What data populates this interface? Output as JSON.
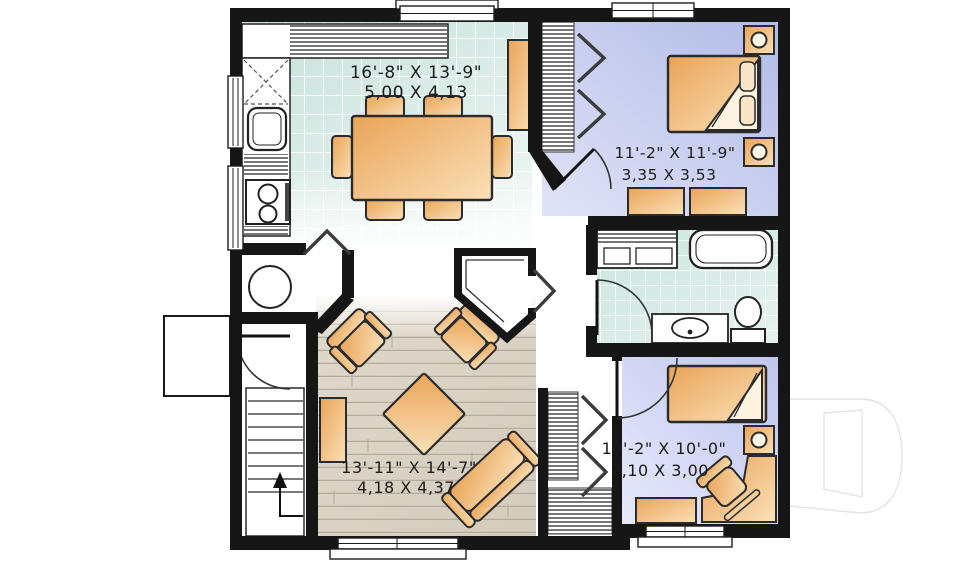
{
  "plan": {
    "type": "floor-plan",
    "rooms": [
      {
        "id": "kitchen-dining",
        "label_imperial": "16'-8\" X 13'-9\"",
        "label_metric": "5,00 X 4,13",
        "features": [
          "l-shaped-counter",
          "corner-cabinet",
          "sink",
          "range",
          "pantry-cabinet",
          "dining-table",
          "six-chairs"
        ]
      },
      {
        "id": "bedroom-1",
        "label_imperial": "11'-2\" X 11'-9\"",
        "label_metric": "3,35 X 3,53",
        "features": [
          "double-bed",
          "two-night-tables-with-lamps",
          "two-dressers",
          "bifold-closet"
        ]
      },
      {
        "id": "living-room",
        "label_imperial": "13'-11\" X 14'-7\"",
        "label_metric": "4,18 X 4,37",
        "features": [
          "sofa",
          "two-armchairs",
          "coffee-table",
          "tv-console",
          "wood-floor"
        ]
      },
      {
        "id": "bedroom-2",
        "label_imperial": "10'-2\" X 10'-0\"",
        "label_metric": "3,10 X 3,00",
        "features": [
          "bed",
          "night-table-with-lamp",
          "corner-desk",
          "desk-chair",
          "dresser"
        ]
      }
    ],
    "other_spaces": {
      "bathroom": [
        "laundry-unit",
        "bathtub",
        "vanity-sink",
        "toilet"
      ],
      "utility_room": [
        "water-heater"
      ],
      "stairs": [
        "up-arrow"
      ],
      "entry": [
        "front-door",
        "porch"
      ]
    },
    "colors": {
      "wall": "#161616",
      "tile_floor": "#c6e1da",
      "bedroom_floor": "#b2bbe7",
      "wood_floor": "#ded7c9",
      "furniture": "#e9a458",
      "furniture_light": "#fae0b8",
      "watermark_gray": "#e3e3e3"
    }
  }
}
